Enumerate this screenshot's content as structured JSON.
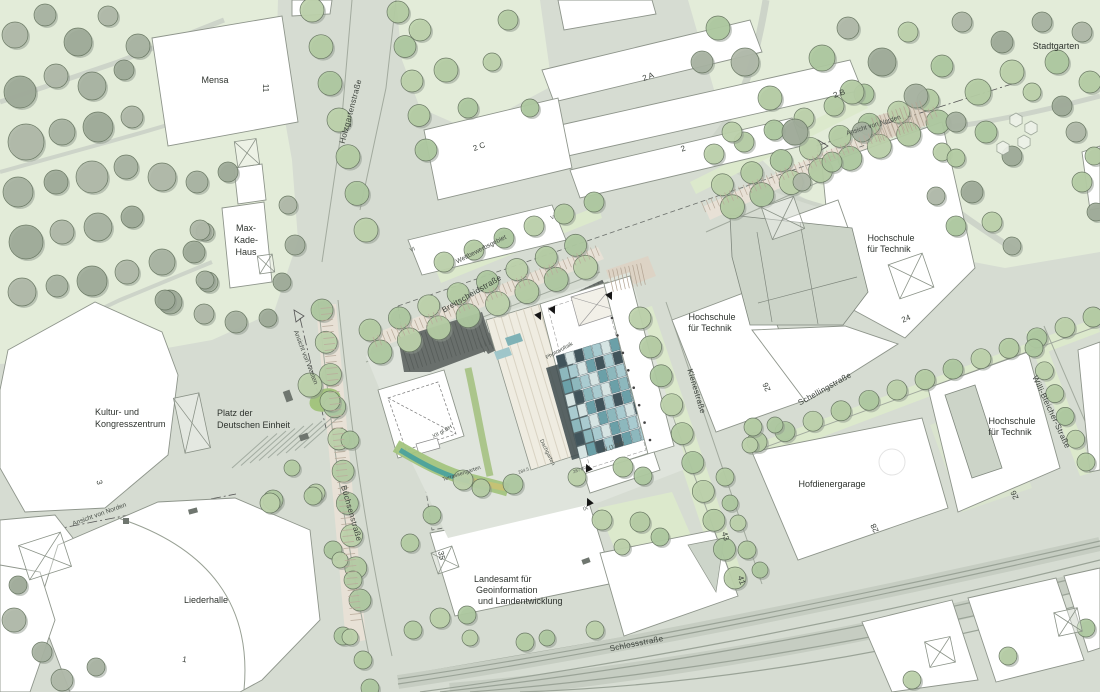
{
  "labels": {
    "mensa": "Mensa",
    "max_kade_1": "Max-",
    "max_kade_2": "Kade-",
    "max_kade_3": "Haus",
    "kultur_1": "Kultur- und",
    "kultur_2": "Kongresszentrum",
    "platz_1": "Platz der",
    "platz_2": "Deutschen Einheit",
    "liederhalle": "Liederhalle",
    "landesamt_1": "Landesamt für",
    "landesamt_2": "Geoinformation",
    "landesamt_3": "und Landentwicklung",
    "hft_west_1": "Hochschule",
    "hft_west_2": "für Technik",
    "hft_north_1": "Hochschule",
    "hft_north_2": "für Technik",
    "hft_south_1": "Hochschule",
    "hft_south_2": "für Technik",
    "hofdienergarage": "Hofdienergarage",
    "stadtgarten": "Stadtgarten"
  },
  "streets": {
    "holzgartenstrasse": "Holzgartenstraße",
    "breitscheidstrasse": "Breitscheidstraße",
    "kienestrasse": "Kienestraße",
    "schellingstrasse": "Schellingstraße",
    "willi_bleicher_strasse": "Willi-Bleicher-Straße",
    "buechsenstrasse": "Büchsenstraße",
    "schlossstrasse": "Schlossstraße"
  },
  "sections": {
    "ansicht_westen": "Ansicht von Westen",
    "ansicht_norden_sw": "Ansicht von Norden",
    "ansicht_norden_ne": "Ansicht von Norden"
  },
  "site": {
    "wettbewerbsgebiet": "Wettbewerbsgebiet",
    "photovoltaik": "Photovoltaik",
    "terrassengarten": "Terrassengarten",
    "dachgarten": "Dachgarten",
    "hochhaus_mark": "XII gl.BH",
    "bauabschnitt": "IV (1.BA)",
    "elev_1": "287.80",
    "elev_2": "284.5"
  },
  "numbers": {
    "mensa_no": "11",
    "kultur_no": "3",
    "liederhalle_no": "1",
    "block_2a": "2 A",
    "block_2b": "2 B",
    "block_2c": "2 C",
    "block_2": "2",
    "hft_24": "24",
    "schelling_26": "26",
    "wbs_26": "26",
    "hof_28": "28",
    "kiene_43": "43",
    "kiene_41": "41",
    "landesamt_35": "35",
    "landesamt_ix": "IX",
    "storey_v": "V",
    "storey_vi": "VI"
  },
  "colors": {
    "background": "#d6dcd2",
    "park_green": "#e3ecd9",
    "building_white": "#ffffff",
    "existing_building_gray": "#ccd4c8",
    "tree_green": "#b5cda4",
    "tree_gray": "#a8b3a2",
    "dark_roof": "#696f6c",
    "glass_teal": "#7fb2b6",
    "garden_ribbon_green": "#a3c47e",
    "water_teal": "#47a09d",
    "crosswalk_tan": "#cfc0ae",
    "rail_gray": "#9aa397",
    "label_text": "#2e332e"
  }
}
